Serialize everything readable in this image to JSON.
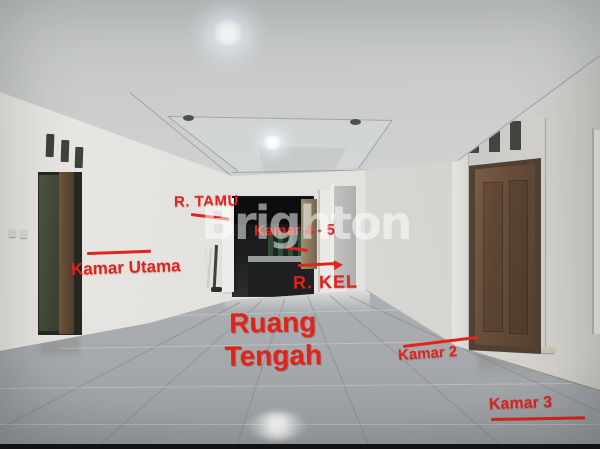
{
  "scene": {
    "watermark": "Brighton",
    "labels": {
      "r_tamu": "R. TAMU",
      "kamar_4_5": "Kamar 4 - 5",
      "r_kel": "R. KEL",
      "kamar_utama": "Kamar Utama",
      "ruang_line1": "Ruang",
      "ruang_line2": "Tengah",
      "kamar_2": "Kamar 2",
      "kamar_3": "Kamar 3"
    },
    "colors": {
      "annotation_red": "#e2231a",
      "watermark": "rgba(255,255,255,0.52)",
      "wall": "#dedcd8",
      "ceiling": "#d2d5d5",
      "floor": "#b6b9bb",
      "wood_door": "#6a4c36",
      "green_door": "#4b5441"
    }
  }
}
